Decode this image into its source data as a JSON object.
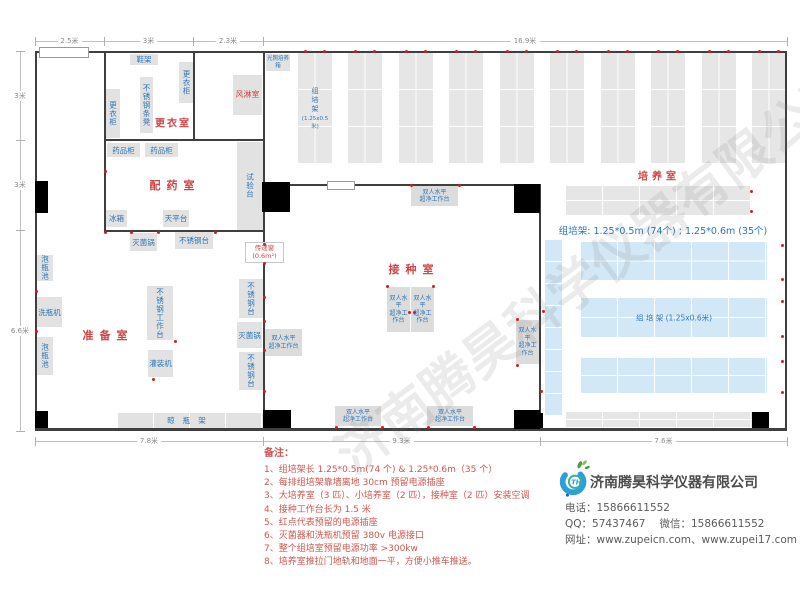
{
  "watermark": {
    "text": "济南腾昊科学仪器有限公司"
  },
  "plan": {
    "rooms": [
      {
        "name": "room-label-changing-room",
        "label": "更衣室",
        "x": 173,
        "y": 122,
        "fs": 10,
        "ls": 2
      },
      {
        "name": "room-label-dispensing-room",
        "label": "配药室",
        "x": 175,
        "y": 185,
        "fs": 11,
        "ls": 6
      },
      {
        "name": "room-label-prep-room",
        "label": "准备室",
        "x": 108,
        "y": 335,
        "fs": 11,
        "ls": 6
      },
      {
        "name": "room-label-inoculation-room",
        "label": "接种室",
        "x": 414,
        "y": 269,
        "fs": 11,
        "ls": 6
      },
      {
        "name": "room-label-culture-room",
        "label": "培养室",
        "x": 659,
        "y": 175,
        "fs": 10,
        "ls": 4
      }
    ],
    "equipment": [
      {
        "id": "shoe-rack",
        "label": "鞋架",
        "x": 130,
        "y": 54,
        "w": 28,
        "h": 11
      },
      {
        "id": "locker",
        "label": "更衣柜",
        "x": 179,
        "y": 62,
        "w": 15,
        "h": 41,
        "v": 1
      },
      {
        "id": "ss-bench",
        "label": "不锈钢条凳",
        "x": 140,
        "y": 77,
        "w": 13,
        "h": 56,
        "v": 1
      },
      {
        "id": "locker",
        "label": "更衣柜",
        "x": 106,
        "y": 89,
        "w": 14,
        "h": 49,
        "v": 1
      },
      {
        "id": "air-shower",
        "label": "风淋室",
        "x": 233,
        "y": 75,
        "w": 29,
        "h": 40,
        "red": 1
      },
      {
        "id": "light-incubator",
        "label": "光照培养箱",
        "x": 266,
        "y": 54,
        "w": 24,
        "h": 17,
        "tiny": 1
      },
      {
        "id": "medicine-cabinet",
        "label": "药品柜",
        "x": 107,
        "y": 143,
        "w": 33,
        "h": 14
      },
      {
        "id": "medicine-cabinet",
        "label": "药品柜",
        "x": 145,
        "y": 143,
        "w": 33,
        "h": 14
      },
      {
        "id": "test-bench",
        "label": "试验台",
        "x": 237,
        "y": 142,
        "w": 26,
        "h": 88,
        "v": 1
      },
      {
        "id": "fridge",
        "label": "冰箱",
        "x": 106,
        "y": 210,
        "w": 21,
        "h": 17
      },
      {
        "id": "balance-table",
        "label": "天平台",
        "x": 163,
        "y": 210,
        "w": 26,
        "h": 17
      },
      {
        "id": "sterilizer",
        "label": "灭菌锅",
        "x": 130,
        "y": 233,
        "w": 27,
        "h": 18
      },
      {
        "id": "ss-table",
        "label": "不锈钢台",
        "x": 175,
        "y": 232,
        "w": 38,
        "h": 17
      },
      {
        "id": "soak-pool",
        "label": "泡瓶池",
        "x": 37,
        "y": 255,
        "w": 16,
        "h": 26,
        "v": 1
      },
      {
        "id": "bottle-washer",
        "label": "洗瓶机",
        "x": 37,
        "y": 297,
        "w": 25,
        "h": 30
      },
      {
        "id": "soak-pool",
        "label": "泡瓶池",
        "x": 37,
        "y": 337,
        "w": 16,
        "h": 38,
        "v": 1
      },
      {
        "id": "ss-worktable",
        "label": "不锈钢工作台",
        "x": 147,
        "y": 286,
        "w": 26,
        "h": 54,
        "v": 1
      },
      {
        "id": "filling-machine",
        "label": "灌装机",
        "x": 148,
        "y": 350,
        "w": 25,
        "h": 27
      },
      {
        "id": "ss-table",
        "label": "不锈钢台",
        "x": 239,
        "y": 279,
        "w": 24,
        "h": 39,
        "v": 1
      },
      {
        "id": "sterilizer",
        "label": "灭菌锅",
        "x": 237,
        "y": 322,
        "w": 25,
        "h": 26
      },
      {
        "id": "ss-table",
        "label": "不锈钢台",
        "x": 239,
        "y": 352,
        "w": 24,
        "h": 38,
        "v": 1
      },
      {
        "id": "drying-rack",
        "label": "晾瓶架",
        "x": 118,
        "y": 413,
        "w": 145,
        "h": 15,
        "grid": 1,
        "ls": 8
      }
    ],
    "bench_label": [
      "双人水平",
      "超净工作台"
    ],
    "benches": [
      {
        "x": 411,
        "y": 186,
        "w": 47,
        "h": 20
      },
      {
        "x": 265,
        "y": 329,
        "w": 37,
        "h": 27
      },
      {
        "x": 387,
        "y": 287,
        "w": 23,
        "h": 45
      },
      {
        "x": 411,
        "y": 287,
        "w": 23,
        "h": 45
      },
      {
        "x": 516,
        "y": 320,
        "w": 23,
        "h": 44
      },
      {
        "x": 335,
        "y": 406,
        "w": 46,
        "h": 20
      },
      {
        "x": 427,
        "y": 406,
        "w": 46,
        "h": 20
      }
    ],
    "transfer_window": {
      "label": "传递窗",
      "size": "(0.6m²)",
      "x": 245,
      "y": 242,
      "w": 37,
      "h": 19
    },
    "racks": {
      "vertical_label": "组培架",
      "vertical_size": "(1.25x0.5米)",
      "spec": "组培架: 1.25*0.5m (74个) ; 1.25*0.6m (35个)",
      "medium_label": "组 培 架 (1.25x0.6米)"
    },
    "dims": {
      "top": [
        {
          "label": "2.5米",
          "a": 35,
          "b": 104
        },
        {
          "label": "3米",
          "a": 104,
          "b": 193
        },
        {
          "label": "2.3米",
          "a": 193,
          "b": 263
        },
        {
          "label": "16.9米",
          "a": 263,
          "b": 787
        }
      ],
      "left": [
        {
          "label": "3米",
          "a": 51,
          "b": 140
        },
        {
          "label": "3米",
          "a": 140,
          "b": 230
        },
        {
          "label": "6.6米",
          "a": 230,
          "b": 431
        }
      ],
      "bottom": [
        {
          "label": "7.8米",
          "a": 35,
          "b": 263
        },
        {
          "label": "9.3米",
          "a": 263,
          "b": 540
        },
        {
          "label": "7.6米",
          "a": 540,
          "b": 787
        }
      ]
    }
  },
  "notes": {
    "title": "备注：",
    "items": [
      "1、组培架长 1.25*0.5m(74 个) & 1.25*0.6m（35 个）",
      "2、每排组培架靠墙离地 30cm 预留电源插座",
      "3、大培养室（3 匹）、小培养室（2 匹），接种室（2 匹）安装空调",
      "4、接种工作台长为 1.5 米",
      "5、红点代表预留的电源插座",
      "6、灭菌器和洗瓶机预留 380v 电源接口",
      "7、整个组培室预留电源功率 >300kw",
      "8、培养室推拉门地轨和地面一平，方便小推车推送。"
    ]
  },
  "company": {
    "name": "济南腾昊科学仪器有限公司",
    "phone_label": "电话：",
    "phone": "15866611552",
    "qq_label": "QQ：",
    "qq": "57437467",
    "wechat_label": "微信：",
    "wechat": "15866611552",
    "web_label": "网址：",
    "websites": "www.zupeicn.com、www.zupei17.com"
  },
  "colors": {
    "accent_blue": "#2e75b6",
    "label_red": "#cf4646",
    "notes_red": "#cf564f",
    "outlet_red": "#cf1f1f",
    "rack_gray": "#e6e6e6",
    "rack_blue": "#d2e8f6",
    "wall": "#3f3f3f"
  }
}
